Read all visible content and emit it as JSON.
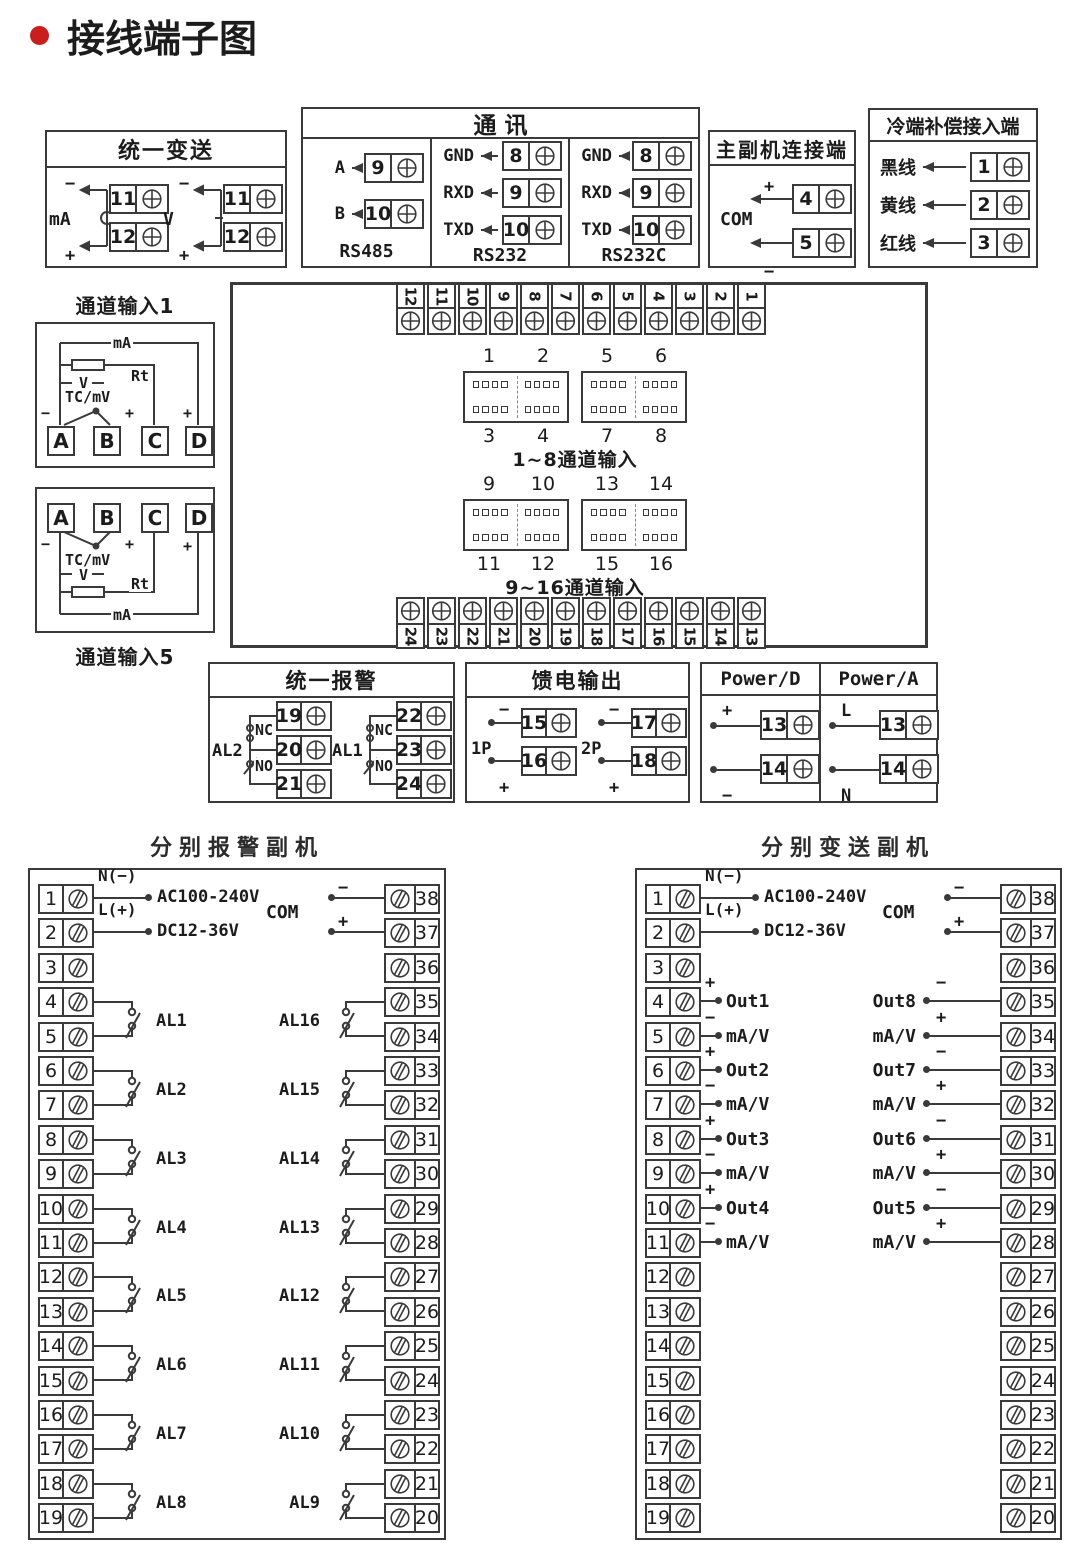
{
  "page": {
    "title": "接线端子图",
    "accent": "#c81e1e",
    "line_color": "#3a3a3a"
  },
  "transmit": {
    "title": "统一变送",
    "groups": [
      {
        "label": "mA",
        "minus": "−",
        "plus": "+",
        "terminals": [
          "11",
          "12"
        ]
      },
      {
        "label": "V",
        "minus": "−",
        "plus": "+",
        "terminals": [
          "11",
          "12"
        ]
      }
    ]
  },
  "comm": {
    "title": "通  讯",
    "columns": [
      {
        "caption": "RS485",
        "rows": [
          {
            "label": "A",
            "num": "9"
          },
          {
            "label": "B",
            "num": "10"
          }
        ]
      },
      {
        "caption": "RS232",
        "rows": [
          {
            "label": "GND",
            "num": "8"
          },
          {
            "label": "RXD",
            "num": "9"
          },
          {
            "label": "TXD",
            "num": "10"
          }
        ]
      },
      {
        "caption": "RS232C",
        "rows": [
          {
            "label": "GND",
            "num": "8"
          },
          {
            "label": "RXD",
            "num": "9"
          },
          {
            "label": "TXD",
            "num": "10"
          }
        ]
      }
    ]
  },
  "master": {
    "title": "主副机连接端",
    "com_label": "COM",
    "rows": [
      {
        "sign": "+",
        "num": "4"
      },
      {
        "sign": "−",
        "num": "5"
      }
    ]
  },
  "cold": {
    "title": "冷端补偿接入端",
    "rows": [
      {
        "label": "黑线",
        "num": "1"
      },
      {
        "label": "黄线",
        "num": "2"
      },
      {
        "label": "红线",
        "num": "3"
      }
    ]
  },
  "channel1": {
    "title": "通道输入1",
    "labels": {
      "ma": "mA",
      "rt": "Rt",
      "v": "V",
      "tc": "TC/mV",
      "minus": "−",
      "plus_b": "+",
      "plus_d": "+"
    },
    "terminals": [
      "A",
      "B",
      "C",
      "D"
    ]
  },
  "channel5": {
    "title": "通道输入5",
    "labels": {
      "ma": "mA",
      "rt": "Rt",
      "v": "V",
      "tc": "TC/mV",
      "minus": "−",
      "plus_b": "+",
      "plus_d": "+"
    },
    "terminals": [
      "A",
      "B",
      "C",
      "D"
    ]
  },
  "center": {
    "top_strip": [
      "12",
      "11",
      "10",
      "9",
      "8",
      "7",
      "6",
      "5",
      "4",
      "3",
      "2",
      "1"
    ],
    "bottom_strip": [
      "24",
      "23",
      "22",
      "21",
      "20",
      "19",
      "18",
      "17",
      "16",
      "15",
      "14",
      "13"
    ],
    "groups": [
      {
        "top_labels": [
          "1",
          "2",
          "5",
          "6"
        ],
        "bottom_labels": [
          "3",
          "4",
          "7",
          "8"
        ],
        "caption": "1~8通道输入"
      },
      {
        "top_labels": [
          "9",
          "10",
          "13",
          "14"
        ],
        "bottom_labels": [
          "11",
          "12",
          "15",
          "16"
        ],
        "caption": "9~16通道输入"
      }
    ]
  },
  "alarm": {
    "title": "统一报警",
    "relays": [
      {
        "label": "AL2",
        "nc": "NC",
        "no": "NO",
        "terminals": [
          "19",
          "20",
          "21"
        ]
      },
      {
        "label": "AL1",
        "nc": "NC",
        "no": "NO",
        "terminals": [
          "22",
          "23",
          "24"
        ]
      }
    ]
  },
  "feed": {
    "title": "馈电输出",
    "groups": [
      {
        "label": "1P",
        "rows": [
          {
            "sign": "−",
            "num": "15"
          },
          {
            "sign": "+",
            "num": "16"
          }
        ]
      },
      {
        "label": "2P",
        "rows": [
          {
            "sign": "−",
            "num": "17"
          },
          {
            "sign": "+",
            "num": "18"
          }
        ]
      }
    ]
  },
  "power": {
    "columns": [
      {
        "title": "Power/D",
        "rows": [
          {
            "sign": "+",
            "num": "13"
          },
          {
            "sign": "−",
            "num": "14"
          }
        ]
      },
      {
        "title": "Power/A",
        "rows": [
          {
            "sign": "L",
            "num": "13"
          },
          {
            "sign": "N",
            "num": "14"
          }
        ]
      }
    ]
  },
  "alarm_slave": {
    "title": "分别报警副机",
    "left_terminals": [
      "1",
      "2",
      "3",
      "4",
      "5",
      "6",
      "7",
      "8",
      "9",
      "10",
      "11",
      "12",
      "13",
      "14",
      "15",
      "16",
      "17",
      "18",
      "19"
    ],
    "right_terminals": [
      "38",
      "37",
      "36",
      "35",
      "34",
      "33",
      "32",
      "31",
      "30",
      "29",
      "28",
      "27",
      "26",
      "25",
      "24",
      "23",
      "22",
      "21",
      "20"
    ],
    "power_lines": [
      {
        "row": 1,
        "label": "N(−)",
        "text": "AC100-240V"
      },
      {
        "row": 2,
        "label": "L(+)",
        "text": "DC12-36V"
      }
    ],
    "com": {
      "label": "COM",
      "signs": [
        "−",
        "+"
      ]
    },
    "left_relays": [
      {
        "label": "AL1",
        "terminals": [
          4,
          5
        ]
      },
      {
        "label": "AL2",
        "terminals": [
          6,
          7
        ]
      },
      {
        "label": "AL3",
        "terminals": [
          8,
          9
        ]
      },
      {
        "label": "AL4",
        "terminals": [
          10,
          11
        ]
      },
      {
        "label": "AL5",
        "terminals": [
          12,
          13
        ]
      },
      {
        "label": "AL6",
        "terminals": [
          14,
          15
        ]
      },
      {
        "label": "AL7",
        "terminals": [
          16,
          17
        ]
      },
      {
        "label": "AL8",
        "terminals": [
          18,
          19
        ]
      }
    ],
    "right_relays": [
      {
        "label": "AL16",
        "terminals": [
          35,
          34
        ]
      },
      {
        "label": "AL15",
        "terminals": [
          33,
          32
        ]
      },
      {
        "label": "AL14",
        "terminals": [
          31,
          30
        ]
      },
      {
        "label": "AL13",
        "terminals": [
          29,
          28
        ]
      },
      {
        "label": "AL12",
        "terminals": [
          27,
          26
        ]
      },
      {
        "label": "AL11",
        "terminals": [
          25,
          24
        ]
      },
      {
        "label": "AL10",
        "terminals": [
          23,
          22
        ]
      },
      {
        "label": "AL9",
        "terminals": [
          21,
          20
        ]
      }
    ]
  },
  "transmit_slave": {
    "title": "分别变送副机",
    "left_terminals": [
      "1",
      "2",
      "3",
      "4",
      "5",
      "6",
      "7",
      "8",
      "9",
      "10",
      "11",
      "12",
      "13",
      "14",
      "15",
      "16",
      "17",
      "18",
      "19"
    ],
    "right_terminals": [
      "38",
      "37",
      "36",
      "35",
      "34",
      "33",
      "32",
      "31",
      "30",
      "29",
      "28",
      "27",
      "26",
      "25",
      "24",
      "23",
      "22",
      "21",
      "20"
    ],
    "power_lines": [
      {
        "row": 1,
        "label": "N(−)",
        "text": "AC100-240V"
      },
      {
        "row": 2,
        "label": "L(+)",
        "text": "DC12-36V"
      }
    ],
    "com": {
      "label": "COM",
      "signs": [
        "−",
        "+"
      ]
    },
    "left_outputs": [
      {
        "row": 4,
        "sign": "+",
        "label": "Out1"
      },
      {
        "row": 5,
        "sign": "−",
        "label": "mA/V"
      },
      {
        "row": 6,
        "sign": "+",
        "label": "Out2"
      },
      {
        "row": 7,
        "sign": "−",
        "label": "mA/V"
      },
      {
        "row": 8,
        "sign": "+",
        "label": "Out3"
      },
      {
        "row": 9,
        "sign": "−",
        "label": "mA/V"
      },
      {
        "row": 10,
        "sign": "+",
        "label": "Out4"
      },
      {
        "row": 11,
        "sign": "−",
        "label": "mA/V"
      }
    ],
    "right_outputs": [
      {
        "row": 35,
        "sign": "−",
        "label": "Out8"
      },
      {
        "row": 34,
        "sign": "+",
        "label": "mA/V"
      },
      {
        "row": 33,
        "sign": "−",
        "label": "Out7"
      },
      {
        "row": 32,
        "sign": "+",
        "label": "mA/V"
      },
      {
        "row": 31,
        "sign": "−",
        "label": "Out6"
      },
      {
        "row": 30,
        "sign": "+",
        "label": "mA/V"
      },
      {
        "row": 29,
        "sign": "−",
        "label": "Out5"
      },
      {
        "row": 28,
        "sign": "+",
        "label": "mA/V"
      }
    ]
  }
}
